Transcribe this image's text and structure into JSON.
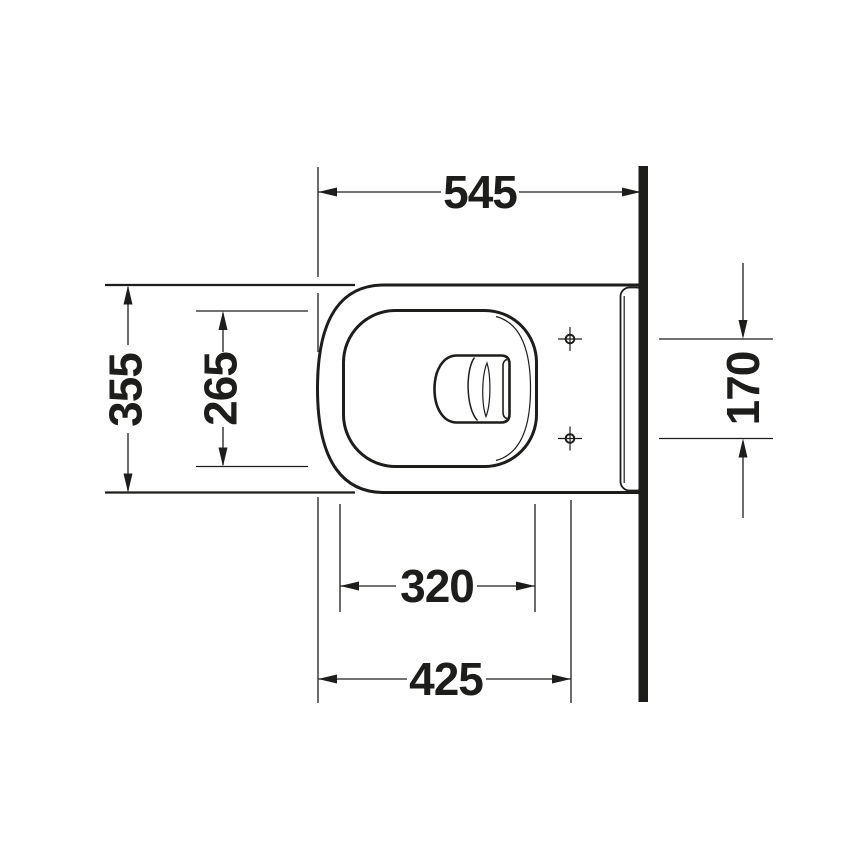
{
  "diagram": {
    "kind": "technical-drawing",
    "view": "wall-hung-toilet-plan-view",
    "colors": {
      "line": "#1d1d1b",
      "background": "#ffffff"
    },
    "dimensions": [
      {
        "id": "overall-depth",
        "label": "545",
        "orientation": "horizontal"
      },
      {
        "id": "overall-width",
        "label": "355",
        "orientation": "vertical"
      },
      {
        "id": "seat-opening-width",
        "label": "265",
        "orientation": "vertical"
      },
      {
        "id": "fixing-hole-spacing",
        "label": "170",
        "orientation": "vertical"
      },
      {
        "id": "seat-opening-depth",
        "label": "320",
        "orientation": "horizontal"
      },
      {
        "id": "fixing-hole-distance",
        "label": "425",
        "orientation": "horizontal"
      }
    ]
  }
}
